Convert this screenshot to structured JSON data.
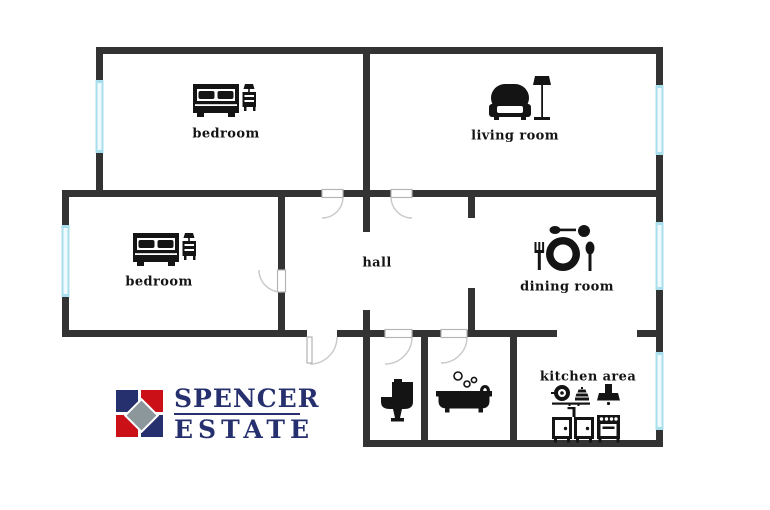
{
  "colors": {
    "wall": "#333333",
    "window": "#a9dfec",
    "window-light": "#eefafd",
    "door": "#b5b5b5",
    "door-arc": "#c9c9c9",
    "ink": "#141414",
    "logo-navy": "#27306e",
    "logo-red": "#cb1117",
    "logo-gray": "#8c979c"
  },
  "floorplan": {
    "type": "apartment-floor-plan",
    "rooms": [
      {
        "id": "bedroom-top",
        "label": "bedroom",
        "icon": "double-bed-with-nightstand-icon"
      },
      {
        "id": "living-room",
        "label": "living room",
        "icon": "armchair-and-floor-lamp-icon"
      },
      {
        "id": "bedroom-left",
        "label": "bedroom",
        "icon": "double-bed-with-nightstand-icon"
      },
      {
        "id": "hall",
        "label": "hall",
        "icon": ""
      },
      {
        "id": "dining-room",
        "label": "dining room",
        "icon": "plate-with-cutlery-icon"
      },
      {
        "id": "kitchen-area",
        "label": "kitchen area",
        "icon": "pan-steamer-hood-cabinets-stove-icons"
      },
      {
        "id": "wc",
        "label": "",
        "icon": "toilet-icon"
      },
      {
        "id": "bathroom",
        "label": "",
        "icon": "bathtub-with-bubbles-icon"
      }
    ],
    "window_count": 5,
    "door_count": 6
  },
  "logo": {
    "line1": "SPENCER",
    "line2": "ESTATE"
  }
}
